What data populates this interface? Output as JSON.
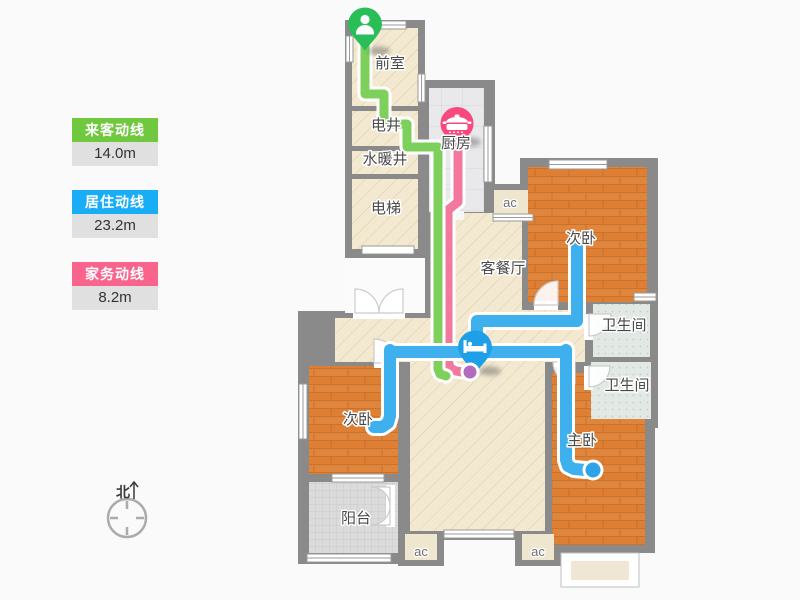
{
  "legend": {
    "items": [
      {
        "label": "来客动线",
        "value": "14.0m",
        "color": "#6FC83E"
      },
      {
        "label": "居住动线",
        "value": "23.2m",
        "color": "#19ADF5"
      },
      {
        "label": "家务动线",
        "value": "8.2m",
        "color": "#F8648C"
      }
    ]
  },
  "compass": {
    "north_label": "北"
  },
  "plan": {
    "rooms": {
      "front_room": "前室",
      "electric_shaft": "电井",
      "plumbing_shaft": "水暖井",
      "elevator": "电梯",
      "kitchen": "厨房",
      "living_dining": "客餐厅",
      "bedroom_top_right": "次卧",
      "bathroom_upper": "卫生间",
      "bathroom_lower": "卫生间",
      "master_bedroom": "主卧",
      "bedroom_left": "次卧",
      "balcony": "阳台",
      "ac": "ac"
    },
    "colors": {
      "visitor_line": "#7ED05C",
      "living_line": "#3FB0EE",
      "housework_line": "#F2789E",
      "visitor_pin": "#29BE58",
      "cooking_pin": "#F8487E",
      "bed_pin": "#1E9FE8",
      "housework_end_dot": "#B16CC0",
      "living_end_dot": "#2FA3E8",
      "wall": "#8A8A8A"
    }
  }
}
